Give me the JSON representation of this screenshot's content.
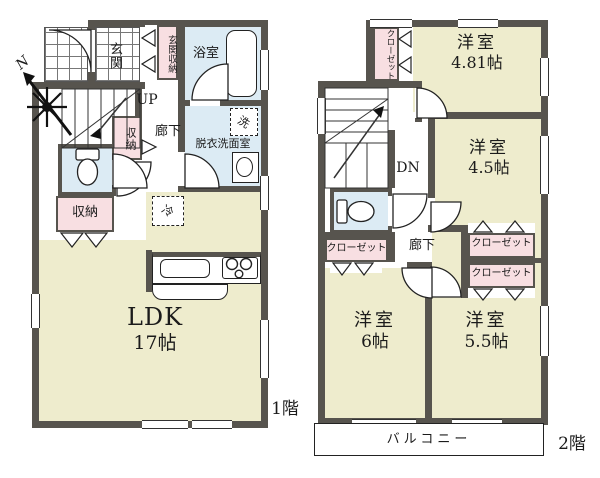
{
  "palette": {
    "wall": "#57544e",
    "room": "#eeeccd",
    "wet": "#dcebf4",
    "closet": "#f8dfe2"
  },
  "compass": {
    "north_label": "N"
  },
  "floor1": {
    "floor_label": "1階",
    "genkan": "玄関",
    "genkan_storage": "玄関収納",
    "bath": "浴室",
    "laundry_room": "脱衣洗面室",
    "washer_mark": "洗",
    "stairs_up": "UP",
    "corridor": "廊下",
    "storage_upper": "収納",
    "storage_lower": "収納",
    "fridge_mark": "冷",
    "ldk_name": "LDK",
    "ldk_size": "17帖"
  },
  "floor2": {
    "floor_label": "2階",
    "closet_top": "クローゼット",
    "room_481_name": "洋室",
    "room_481_size": "4.81帖",
    "room_45_name": "洋室",
    "room_45_size": "4.5帖",
    "stairs_down": "DN",
    "corridor": "廊下",
    "closet_left": "クローゼット",
    "closet_right_upper": "クローゼット",
    "closet_right_lower": "クローゼット",
    "room_6_name": "洋室",
    "room_6_size": "6帖",
    "room_55_name": "洋室",
    "room_55_size": "5.5帖",
    "balcony": "バルコニー"
  }
}
